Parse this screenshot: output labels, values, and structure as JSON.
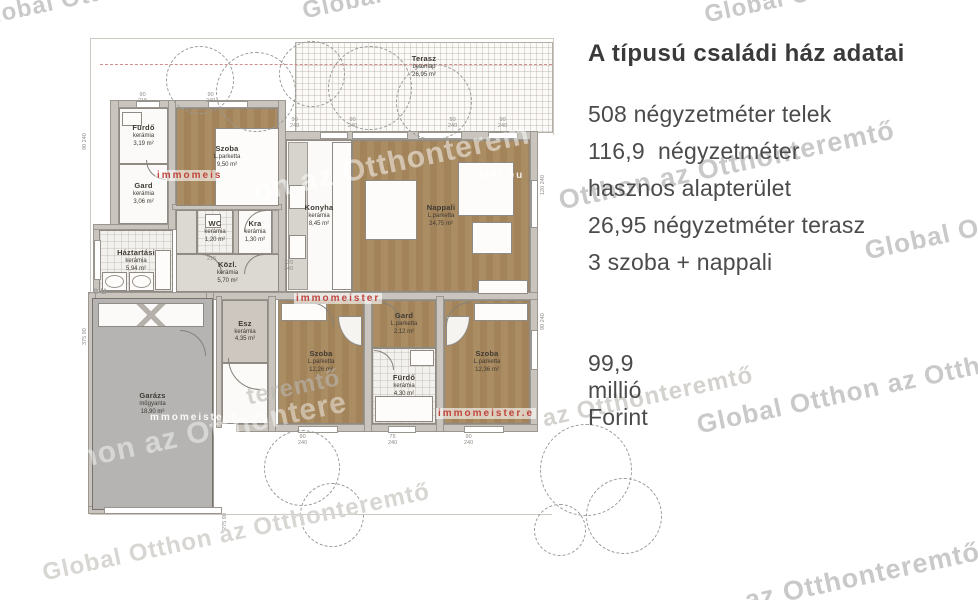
{
  "info_panel": {
    "title": "A típusú családi ház adatai",
    "lines": [
      "508 négyzetméter telek",
      "116,9  négyzetméter",
      "hasznos alapterület",
      "26,95 négyzetméter terasz",
      "3 szoba + nappali"
    ],
    "price": "99,9 millió Forint"
  },
  "floor_plan": {
    "terasz": {
      "name": "Terasz",
      "material": "betonlap",
      "area": "26,95 m²",
      "bbox": [
        295,
        42,
        258,
        91
      ]
    },
    "rooms": [
      {
        "name": "Fürdő",
        "material": "kerámia",
        "area": "3,19 m²",
        "floor": "white",
        "bbox": [
          119,
          108,
          49,
          56
        ]
      },
      {
        "name": "Gard",
        "material": "kerámia",
        "area": "3,06 m²",
        "floor": "white",
        "bbox": [
          119,
          164,
          49,
          60
        ]
      },
      {
        "name": "Szoba",
        "material": "L.parketta",
        "area": "9,50 m²",
        "floor": "wood",
        "bbox": [
          176,
          108,
          102,
          98
        ]
      },
      {
        "name": "Háztartási",
        "material": "kerámia",
        "area": "5,94 m²",
        "floor": "tile",
        "bbox": [
          99,
          230,
          74,
          62
        ]
      },
      {
        "name": "WC",
        "material": "kerámia",
        "area": "1,20 m²",
        "floor": "tile",
        "bbox": [
          197,
          210,
          36,
          44
        ]
      },
      {
        "name": "Kra",
        "material": "kerámia",
        "area": "1,30 m²",
        "floor": "white",
        "bbox": [
          238,
          210,
          34,
          44
        ]
      },
      {
        "name": "",
        "material": "",
        "area": "",
        "floor": "hall",
        "bbox": [
          176,
          210,
          21,
          44
        ]
      },
      {
        "name": "Közl.",
        "material": "kerámia",
        "area": "5,70 m²",
        "floor": "hall",
        "bbox": [
          176,
          254,
          103,
          38
        ]
      },
      {
        "name": "Konyha",
        "material": "kerámia",
        "area": "8,45 m²",
        "floor": "white",
        "bbox": [
          286,
          140,
          66,
          152
        ]
      },
      {
        "name": "Nappali",
        "material": "L.parketta",
        "area": "24,75 m²",
        "floor": "wood",
        "bbox": [
          352,
          140,
          178,
          152
        ]
      },
      {
        "name": "Esz",
        "material": "kerámia",
        "area": "4,35 m²",
        "floor": "beige",
        "bbox": [
          222,
          300,
          46,
          63
        ]
      },
      {
        "name": "",
        "material": "",
        "area": "",
        "floor": "white",
        "bbox": [
          222,
          363,
          46,
          61
        ]
      },
      {
        "name": "Szoba",
        "material": "L.parketta",
        "area": "12,26 m²",
        "floor": "wood",
        "bbox": [
          278,
          300,
          86,
          124
        ]
      },
      {
        "name": "Gard",
        "material": "L.parketta",
        "area": "2,12 m²",
        "floor": "wood",
        "bbox": [
          372,
          300,
          64,
          48
        ]
      },
      {
        "name": "Fürdő",
        "material": "kerámia",
        "area": "4,30 m²",
        "floor": "tile",
        "bbox": [
          372,
          348,
          64,
          76
        ]
      },
      {
        "name": "Szoba",
        "material": "L.parketta",
        "area": "12,36 m²",
        "floor": "wood",
        "bbox": [
          444,
          300,
          86,
          124
        ]
      },
      {
        "name": "Garázs",
        "material": "műgyanta",
        "area": "18,90 m²",
        "floor": "garage",
        "bbox": [
          92,
          298,
          121,
          212
        ]
      }
    ],
    "walls": [
      [
        110,
        100,
        176,
        8
      ],
      [
        283,
        131,
        255,
        9
      ],
      [
        110,
        100,
        9,
        130
      ],
      [
        93,
        224,
        9,
        74
      ],
      [
        93,
        224,
        82,
        6
      ],
      [
        530,
        131,
        8,
        301
      ],
      [
        88,
        292,
        450,
        8
      ],
      [
        236,
        424,
        302,
        8
      ],
      [
        88,
        292,
        8,
        222
      ],
      [
        206,
        292,
        8,
        222
      ],
      [
        88,
        506,
        126,
        8
      ],
      [
        168,
        100,
        8,
        130
      ],
      [
        278,
        100,
        8,
        192
      ],
      [
        172,
        204,
        110,
        6
      ],
      [
        364,
        296,
        8,
        136
      ],
      [
        436,
        296,
        8,
        136
      ],
      [
        268,
        296,
        8,
        136
      ],
      [
        216,
        296,
        6,
        132
      ],
      [
        233,
        210,
        6,
        44
      ],
      [
        272,
        210,
        7,
        44
      ]
    ],
    "lines": [
      [
        90,
        38,
        464,
        1
      ],
      [
        90,
        38,
        1,
        477
      ],
      [
        90,
        514,
        462,
        1
      ],
      [
        553,
        38,
        1,
        97
      ]
    ],
    "windows": [
      [
        320,
        132,
        28,
        7
      ],
      [
        352,
        132,
        56,
        7
      ],
      [
        418,
        132,
        44,
        7
      ],
      [
        488,
        132,
        30,
        7
      ],
      [
        136,
        101,
        24,
        7
      ],
      [
        208,
        101,
        40,
        7
      ],
      [
        298,
        426,
        40,
        7
      ],
      [
        388,
        426,
        28,
        7
      ],
      [
        464,
        426,
        40,
        7
      ],
      [
        531,
        180,
        7,
        48
      ],
      [
        531,
        330,
        7,
        40
      ],
      [
        104,
        507,
        118,
        7
      ],
      [
        94,
        240,
        7,
        40
      ]
    ],
    "furniture": [
      {
        "n": "bed",
        "cls": "furn",
        "b": [
          215,
          128,
          64,
          78
        ]
      },
      {
        "n": "dining-table",
        "cls": "furn",
        "b": [
          365,
          180,
          52,
          60
        ]
      },
      {
        "n": "sofa",
        "cls": "furn",
        "b": [
          458,
          162,
          56,
          54
        ]
      },
      {
        "n": "sofa-2",
        "cls": "furn",
        "b": [
          472,
          222,
          40,
          32
        ]
      },
      {
        "n": "rug",
        "cls": "furn",
        "b": [
          478,
          280,
          50,
          14
        ]
      },
      {
        "n": "kitchen-counter-left",
        "cls": "counter",
        "b": [
          288,
          142,
          20,
          148
        ]
      },
      {
        "n": "kitchen-counter-right",
        "cls": "furn",
        "b": [
          332,
          142,
          20,
          148
        ]
      },
      {
        "n": "stove",
        "cls": "furn",
        "b": [
          289,
          185,
          17,
          24
        ]
      },
      {
        "n": "kitchen-sink",
        "cls": "furn",
        "b": [
          289,
          235,
          17,
          24
        ]
      },
      {
        "n": "washing-machine",
        "cls": "machine",
        "b": [
          102,
          272,
          25,
          19
        ]
      },
      {
        "n": "dryer",
        "cls": "machine",
        "b": [
          129,
          272,
          25,
          19
        ]
      },
      {
        "n": "laundry-counter",
        "cls": "furn",
        "b": [
          155,
          250,
          16,
          40
        ]
      },
      {
        "n": "bathtub",
        "cls": "furn",
        "b": [
          375,
          396,
          58,
          26
        ]
      },
      {
        "n": "bathroom-sink",
        "cls": "furn",
        "b": [
          410,
          350,
          24,
          16
        ]
      },
      {
        "n": "toilet",
        "cls": "furn",
        "b": [
          205,
          214,
          16,
          14
        ]
      },
      {
        "n": "sink-small",
        "cls": "furn",
        "b": [
          122,
          112,
          20,
          14
        ]
      },
      {
        "n": "closet-left",
        "cls": "furn",
        "b": [
          281,
          303,
          46,
          18
        ]
      },
      {
        "n": "closet-right",
        "cls": "furn",
        "b": [
          474,
          303,
          54,
          18
        ]
      },
      {
        "n": "wardrobe-fan-left",
        "cls": "fan",
        "b": [
          338,
          316,
          24,
          30
        ],
        "r": "0 0 0 100%"
      },
      {
        "n": "wardrobe-fan-right",
        "cls": "fan",
        "b": [
          446,
          316,
          24,
          30
        ],
        "r": "0 0 100% 0"
      },
      {
        "n": "garage-shelf",
        "cls": "xband",
        "b": [
          98,
          303,
          106,
          24
        ]
      }
    ],
    "arcs": [
      {
        "x": 202,
        "y": 254,
        "r": 20,
        "c": "tr"
      },
      {
        "x": 244,
        "y": 254,
        "r": 20,
        "c": "tl"
      },
      {
        "x": 228,
        "y": 358,
        "r": 32,
        "c": "bl"
      },
      {
        "x": 310,
        "y": 302,
        "r": 24,
        "c": "tr"
      },
      {
        "x": 446,
        "y": 302,
        "r": 24,
        "c": "tl"
      },
      {
        "x": 380,
        "y": 302,
        "r": 20,
        "c": "tr"
      },
      {
        "x": 374,
        "y": 350,
        "r": 20,
        "c": "tr"
      },
      {
        "x": 146,
        "y": 160,
        "r": 20,
        "c": "bl"
      },
      {
        "x": 244,
        "y": 210,
        "r": 22,
        "c": "tl"
      },
      {
        "x": 180,
        "y": 330,
        "r": 26,
        "c": "tr"
      }
    ],
    "trees": [
      {
        "cx": 200,
        "cy": 80,
        "r": 34
      },
      {
        "cx": 256,
        "cy": 92,
        "r": 40
      },
      {
        "cx": 312,
        "cy": 74,
        "r": 33
      },
      {
        "cx": 370,
        "cy": 88,
        "r": 42
      },
      {
        "cx": 434,
        "cy": 102,
        "r": 38
      },
      {
        "cx": 302,
        "cy": 468,
        "r": 38
      },
      {
        "cx": 332,
        "cy": 515,
        "r": 32
      },
      {
        "cx": 586,
        "cy": 470,
        "r": 46
      },
      {
        "cx": 624,
        "cy": 516,
        "r": 38
      },
      {
        "cx": 560,
        "cy": 530,
        "r": 26
      }
    ],
    "redline": [
      100,
      64,
      452
    ],
    "dims": [
      {
        "t": "90\n240",
        "x": 290,
        "y": 117
      },
      {
        "t": "90\n240",
        "x": 348,
        "y": 117
      },
      {
        "t": "50\n240",
        "x": 448,
        "y": 117
      },
      {
        "t": "90\n240",
        "x": 498,
        "y": 117
      },
      {
        "t": "90\n215",
        "x": 138,
        "y": 92
      },
      {
        "t": "90\n240",
        "x": 206,
        "y": 92
      },
      {
        "t": "120\n240",
        "x": 284,
        "y": 260
      },
      {
        "t": "215",
        "x": 207,
        "y": 256
      },
      {
        "t": "90\n240",
        "x": 298,
        "y": 434
      },
      {
        "t": "75\n240",
        "x": 388,
        "y": 434
      },
      {
        "t": "90\n240",
        "x": 464,
        "y": 434
      },
      {
        "t": "90 240",
        "x": 82,
        "y": 150,
        "rot": 1
      },
      {
        "t": "375 90",
        "x": 82,
        "y": 345,
        "rot": 1
      },
      {
        "t": "120 240",
        "x": 540,
        "y": 195,
        "rot": 1
      },
      {
        "t": "90 240",
        "x": 540,
        "y": 330,
        "rot": 1
      },
      {
        "t": "275 90",
        "x": 222,
        "y": 530,
        "rot": 1
      }
    ]
  },
  "watermarks": {
    "global": [
      {
        "t": "Global Otthon az Otthonteremtő",
        "x": -28,
        "y": 6,
        "s": 24
      },
      {
        "t": "Global Otthon az Otthonteremtő",
        "x": 300,
        "y": -2,
        "s": 24
      },
      {
        "t": "Global Otthon",
        "x": 702,
        "y": 2,
        "s": 24
      },
      {
        "t": "Otthon az Otthonteremtő",
        "x": 556,
        "y": 186,
        "s": 27
      },
      {
        "t": "Global Otthon az Otthonteremtő",
        "x": 862,
        "y": 236,
        "s": 26
      },
      {
        "t": "Global Otthon az Otthonteremtő",
        "x": 694,
        "y": 410,
        "s": 26
      },
      {
        "t": "az Otthonteremtő",
        "x": 540,
        "y": 406,
        "s": 24,
        "c": "#d4d2cf"
      },
      {
        "t": "Global Otthon az Otthonteremtő",
        "x": 40,
        "y": 560,
        "s": 24,
        "c": "#d8d6d3"
      },
      {
        "t": "az Otthonteremtő",
        "x": 742,
        "y": 586,
        "s": 27
      },
      {
        "t": "on az Otthonterem",
        "x": 250,
        "y": 176,
        "s": 30,
        "c": "rgba(255,255,255,0.5)"
      },
      {
        "t": "Otthon az Otthontere",
        "x": 30,
        "y": 452,
        "s": 30,
        "c": "rgba(255,255,255,0.45)"
      },
      {
        "t": "teremtő",
        "x": 244,
        "y": 384,
        "s": 24,
        "c": "rgba(185,183,179,0.6)"
      }
    ],
    "immo": [
      {
        "t": "immomeis",
        "x": 155,
        "y": 170,
        "c": "#c0453d",
        "bg": "rgba(255,255,255,0.6)"
      },
      {
        "t": "immomeister",
        "x": 294,
        "y": 293,
        "c": "#c0453d",
        "bg": "rgba(255,255,255,0.6)"
      },
      {
        "t": "immomeister.e",
        "x": 436,
        "y": 408,
        "c": "#c0453d",
        "bg": "rgba(255,255,255,0.6)"
      },
      {
        "t": "mmomeiste",
        "x": 148,
        "y": 412,
        "c": "rgba(255,255,255,0.92)",
        "bg": "transparent"
      },
      {
        "t": "ster.eu",
        "x": 476,
        "y": 170,
        "c": "rgba(255,255,255,0.85)",
        "bg": "transparent"
      },
      {
        "t": ".eu",
        "x": 86,
        "y": 286,
        "c": "#9a9a9a",
        "bg": "transparent"
      }
    ]
  }
}
